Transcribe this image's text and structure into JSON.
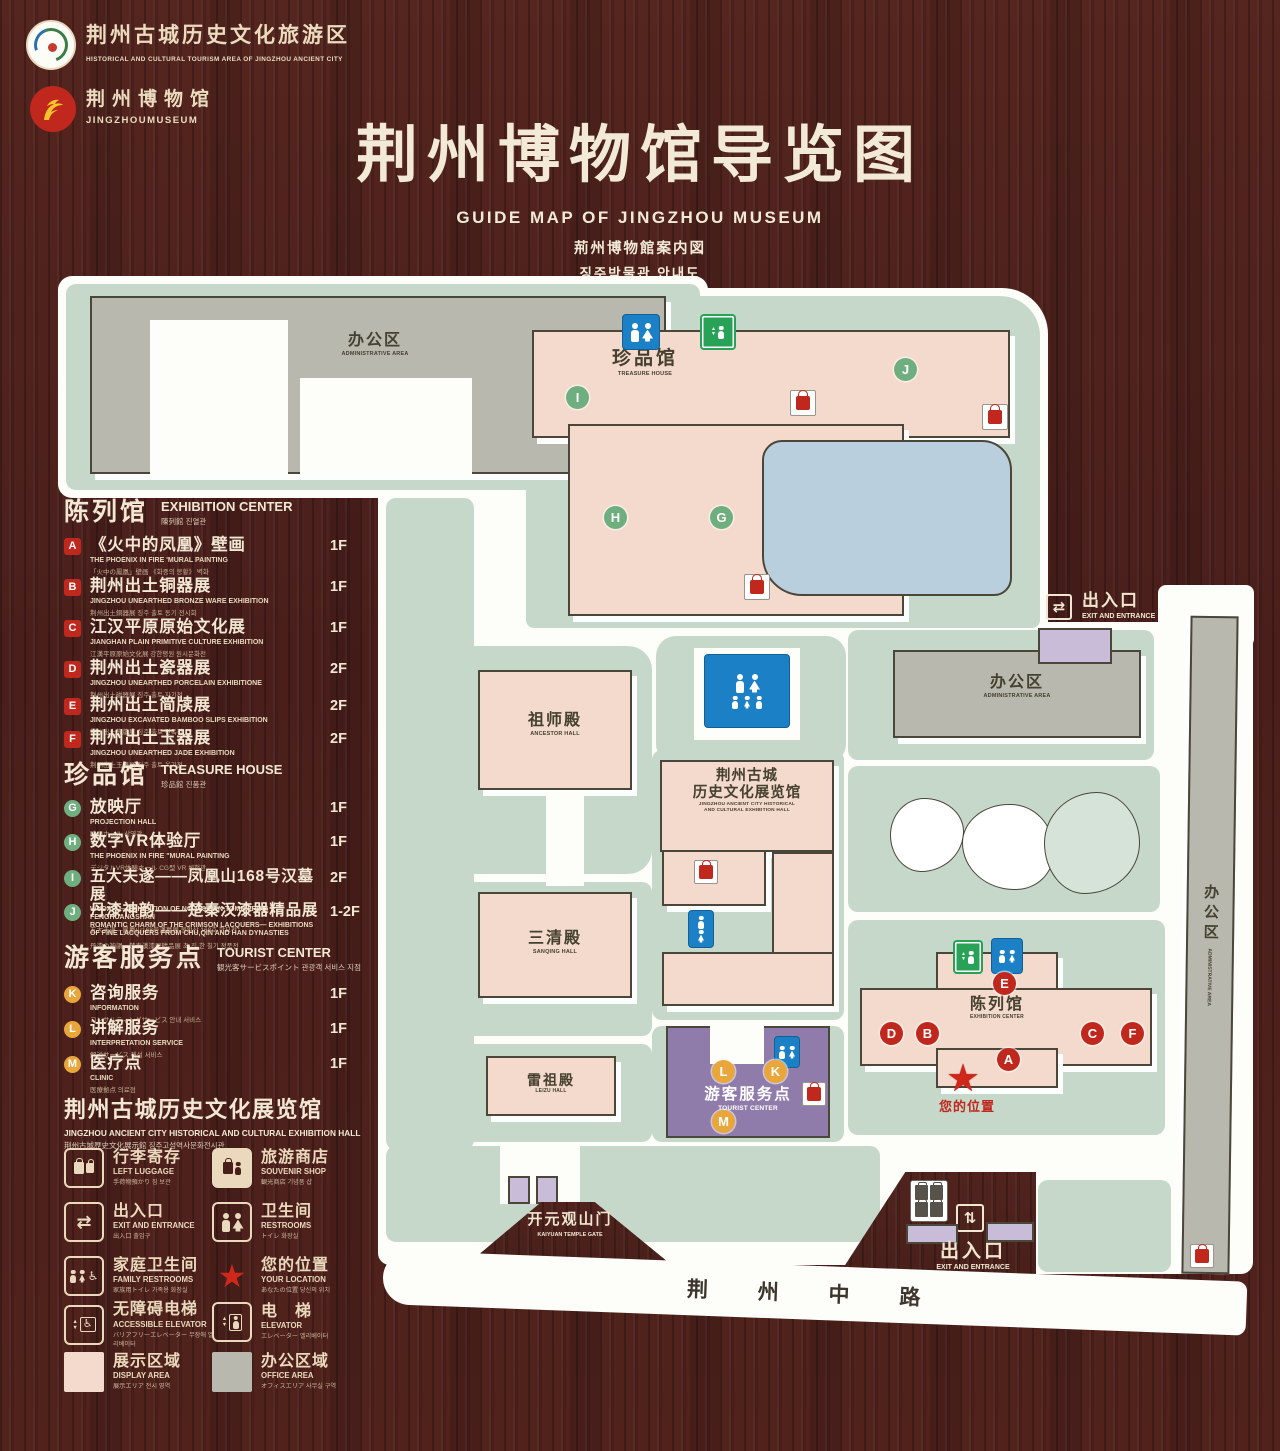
{
  "colors": {
    "wood": "#4a201c",
    "cream": "#ead9bd",
    "map_green": "#c6d8ca",
    "building_pink": "#f3dacc",
    "building_gray": "#b9b8ae",
    "pond_blue": "#b9cfdd",
    "tourist_purple": "#8f7cab",
    "marker_red": "#c0281e",
    "marker_green": "#6fae7e",
    "marker_yellow": "#e9a63b",
    "restroom_blue": "#1b80c5",
    "elevator_green": "#27a257"
  },
  "icons": {
    "star": "★",
    "arrows_h": "⇄",
    "arrows_v": "⇅",
    "up": "▲",
    "down": "▼",
    "wheelchair": "♿"
  },
  "header": {
    "brand1": {
      "zh": "荆州古城历史文化旅游区",
      "en": "HISTORICAL AND CULTURAL TOURISM AREA OF JINGZHOU ANCIENT CITY"
    },
    "brand2": {
      "zh": "荆州博物馆",
      "en": "JINGZHOUMUSEUM"
    },
    "title": "荆州博物馆导览图",
    "subtitle_en": "GUIDE MAP OF JINGZHOU MUSEUM",
    "subtitle_ja": "荊州博物館案内図",
    "subtitle_ko": "징주박물관 안내도"
  },
  "sections": {
    "exhibition": {
      "zh": "陈列馆",
      "en": "EXHIBITION CENTER",
      "sub": "陳列館 진열관",
      "items": [
        {
          "letter": "A",
          "zh": "《火中的凤凰》壁画",
          "en": "THE PHOENIX IN FIRE 'MURAL PAINTING",
          "sub": "「火中の鳳凰」壁画 《화중의 봉황》 벽화",
          "floor": "1F"
        },
        {
          "letter": "B",
          "zh": "荆州出土铜器展",
          "en": "JINGZHOU UNEARTHED BRONZE WARE EXHIBITION",
          "sub": "荆州出土銅器展 징주 출토 동기 전시회",
          "floor": "1F"
        },
        {
          "letter": "C",
          "zh": "江汉平原原始文化展",
          "en": "JIANGHAN PLAIN PRIMITIVE CULTURE EXHIBITION",
          "sub": "江漢平原原始文化展 강한평원 원시문화전",
          "floor": "1F"
        },
        {
          "letter": "D",
          "zh": "荆州出土瓷器展",
          "en": "JINGZHOU UNEARTHED PORCELAIN EXHIBITIONE",
          "sub": "荆州出土磁器展 징주 출토 자기전",
          "floor": "2F"
        },
        {
          "letter": "E",
          "zh": "荆州出土简牍展",
          "en": "JINGZHOU EXCAVATED BAMBOO SLIPS EXHIBITION",
          "sub": "荆州出土簡牘展 징주 출토 간독전",
          "floor": "2F"
        },
        {
          "letter": "F",
          "zh": "荆州出土玉器展",
          "en": "JINGZHOU UNEARTHED JADE EXHIBITION",
          "sub": "荆州出土玉器展 징주 출토 옥기전",
          "floor": "2F"
        }
      ]
    },
    "treasure": {
      "zh": "珍品馆",
      "en": "TREASURE HOUSE",
      "sub": "珍品館 진품관",
      "items": [
        {
          "letter": "G",
          "zh": "放映厅",
          "en": "PROJECTION HALL",
          "sub": "映画ホール 상영관",
          "floor": "1F"
        },
        {
          "letter": "H",
          "zh": "数字VR体验厅",
          "en": "THE PHOENIX IN FIRE \"MURAL PAINTING",
          "sub": "デジタルVR体験ホール CG型 VR 체험관",
          "floor": "1F"
        },
        {
          "letter": "I",
          "zh": "五大夫遂——凤凰山168号汉墓展",
          "en": "WUDAFU—EXHIBITION OF NO.168 HAN TOMB FROM FENGHUANGSHAN",
          "sub": "五大夫遂—鳳凰山168号漢墓展 봉황산 168호 한묘전",
          "floor": "2F"
        },
        {
          "letter": "J",
          "zh": "丹漆神韵——楚秦汉漆器精品展",
          "en": "ROMANTIC CHARM OF THE CRIMSON LACQUERS— EXHIBITIONS OF FINE LACQUERS FROM CHU,QIN AND HAN DYNASTIES",
          "sub": "丹漆の神韻—楚秦漢漆器精品展 초·진·한 칠기 정품전",
          "floor": "1-2F"
        }
      ]
    },
    "tourist": {
      "zh": "游客服务点",
      "en": "TOURIST CENTER",
      "sub": "観光客サービスポイント 관광객 서비스 지점",
      "items": [
        {
          "letter": "K",
          "zh": "咨询服务",
          "en": "INFORMATION",
          "sub": "コンサルティングサービス 안내 서비스",
          "floor": "1F"
        },
        {
          "letter": "L",
          "zh": "讲解服务",
          "en": "INTERPRETATION SERVICE",
          "sub": "解説サービス 해설 서비스",
          "floor": "1F"
        },
        {
          "letter": "M",
          "zh": "医疗点",
          "en": "CLINIC",
          "sub": "医療拠点 의료점",
          "floor": "1F"
        }
      ]
    },
    "hall": {
      "zh": "荆州古城历史文化展览馆",
      "en": "JINGZHOU ANCIENT CITY HISTORICAL AND CULTURAL EXHIBITION HALL",
      "sub": "荆州古城歴史文化展示館 징주고성역사문화전시관"
    }
  },
  "legend": [
    {
      "zh": "行李寄存",
      "en": "LEFT LUGGAGE",
      "sub": "手荷物預かり 짐 보관"
    },
    {
      "zh": "旅游商店",
      "en": "SOUVENIR SHOP",
      "sub": "観光商店 기념품 샵"
    },
    {
      "zh": "出入口",
      "en": "EXIT AND ENTRANCE",
      "sub": "出入口 출입구"
    },
    {
      "zh": "卫生间",
      "en": "RESTROOMS",
      "sub": "トイレ 화장실"
    },
    {
      "zh": "家庭卫生间",
      "en": "FAMILY RESTROOMS",
      "sub": "家族用トイレ 가족용 화장실"
    },
    {
      "zh": "您的位置",
      "en": "YOUR LOCATION",
      "sub": "あなたの位置 당신의 위치"
    },
    {
      "zh": "无障碍电梯",
      "en": "ACCESSIBLE ELEVATOR",
      "sub": "バリアフリーエレベーター 무장애 엘리베이터"
    },
    {
      "zh": "电　梯",
      "en": "ELEVATOR",
      "sub": "エレベーター 엘리베이터"
    },
    {
      "zh": "展示区域",
      "en": "DISPLAY AREA",
      "sub": "展示エリア 전시 영역"
    },
    {
      "zh": "办公区域",
      "en": "OFFICE AREA",
      "sub": "オフィスエリア 사무실 구역"
    }
  ],
  "map": {
    "labels": {
      "admin_tl": {
        "zh": "办公区",
        "en": "ADMINISTRATIVE AREA"
      },
      "treasure": {
        "zh": "珍品馆",
        "en": "TREASURE HOUSE"
      },
      "ancestor": {
        "zh": "祖师殿",
        "en": "ANCESTOR HALL"
      },
      "sanqing": {
        "zh": "三清殿",
        "en": "SANQING HALL"
      },
      "leizu": {
        "zh": "雷祖殿",
        "en": "LEIZU HALL"
      },
      "hall": {
        "zh1": "荆州古城",
        "zh2": "历史文化展览馆",
        "en1": "JINGZHOU ANCIENT CITY HISTORICAL",
        "en2": "AND CULTURAL EXHIBITION HALL"
      },
      "admin_r": {
        "zh": "办公区",
        "en": "ADMINISTRATIVE AREA"
      },
      "exhibition": {
        "zh": "陈列馆",
        "en": "EXHIBITION CENTER"
      },
      "tourist": {
        "zh": "游客服务点",
        "en": "TOURIST CENTER"
      },
      "gate": {
        "zh": "开元观山门",
        "en": "KAIYUAN TEMPLE GATE"
      },
      "exit_top": {
        "zh": "出入口",
        "en": "EXIT AND ENTRANCE"
      },
      "exit_bottom": {
        "zh": "出入口",
        "en": "EXIT AND ENTRANCE"
      },
      "your_location": "您的位置",
      "road": "荆 州 中 路",
      "admin_strip": {
        "zh": "办公区",
        "en": "ADMINISTRATIVE AREA"
      }
    },
    "markers": {
      "a": "A",
      "b": "B",
      "c": "C",
      "d": "D",
      "e": "E",
      "f": "F",
      "g": "G",
      "h": "H",
      "i": "I",
      "j": "J",
      "k": "K",
      "l": "L",
      "m": "M"
    }
  }
}
